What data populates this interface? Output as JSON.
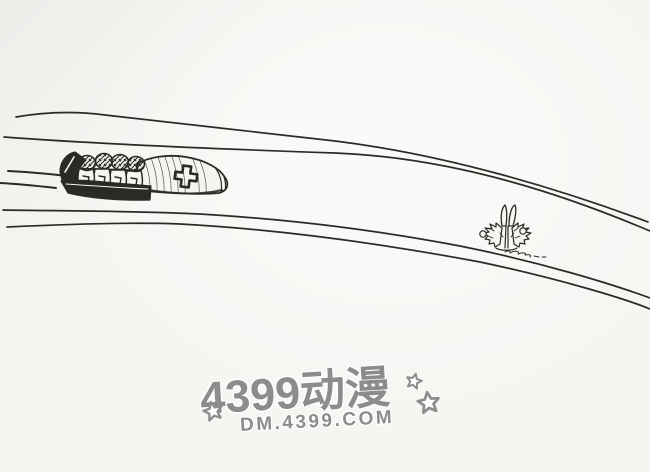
{
  "watermark": {
    "title": "4399动漫",
    "url": "DM.4399.COM",
    "star_icon_count": 3
  },
  "colors": {
    "paper": "#f6f5f2",
    "ink": "#2b2a27",
    "watermark": "#8d8b8c"
  },
  "illustration": {
    "type": "black-and-white cartoon line drawing",
    "elements": [
      "bobsled-track-upper-edge",
      "bobsled-track-lower-edge",
      "four-man-bobsled",
      "swiss-cross-emblem",
      "speed-lines",
      "bush"
    ]
  }
}
